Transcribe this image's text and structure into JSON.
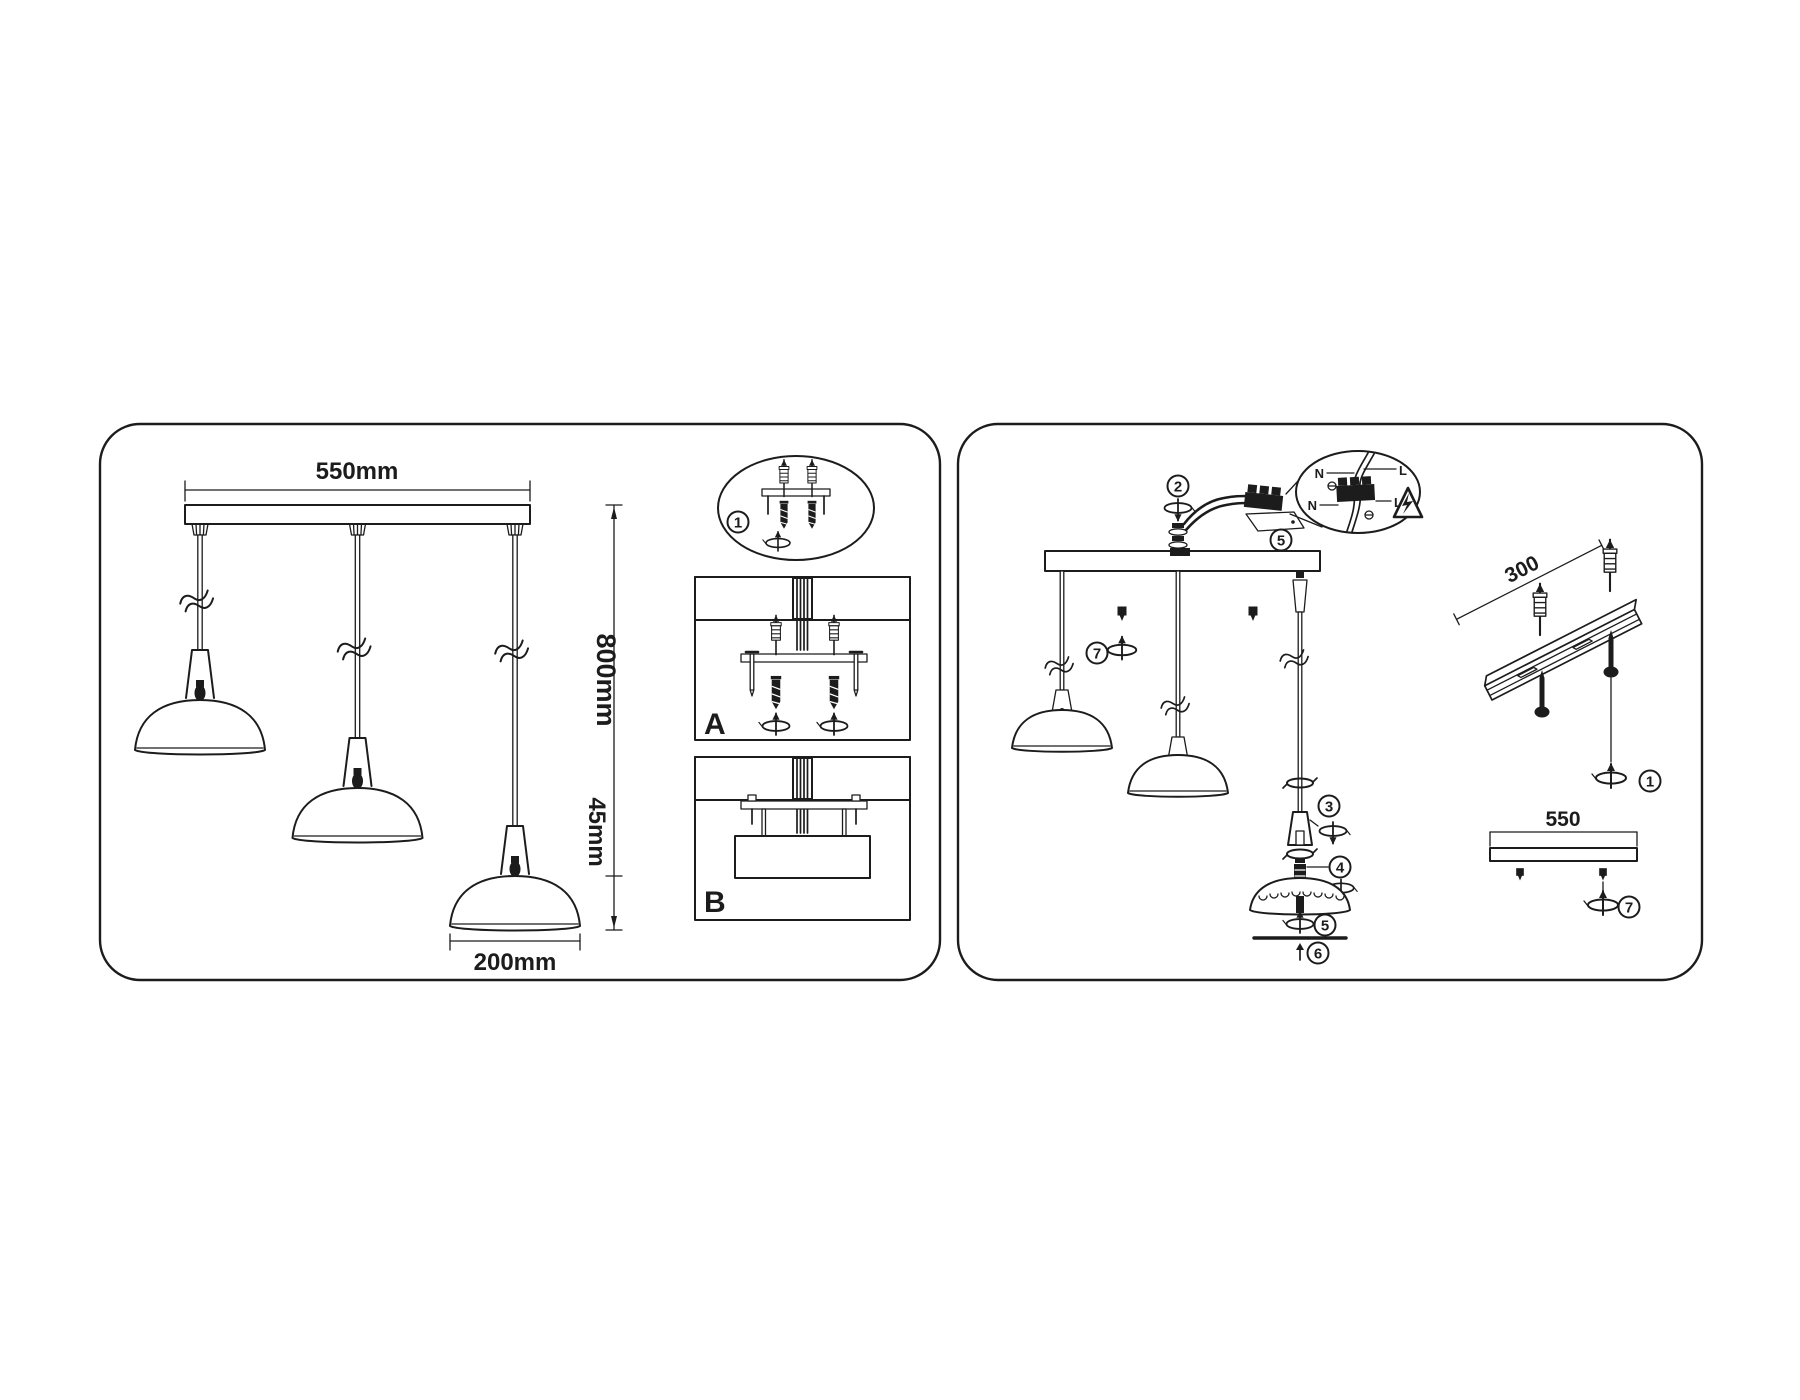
{
  "document_type": "pendant-lamp-installation-diagram",
  "colors": {
    "ink": "#1c1c1c",
    "paper": "#ffffff"
  },
  "icons": {
    "rotation_arrow": "screw-rotation-symbol",
    "warning_electric": "electric-shock-warning-triangle",
    "cable_break": "cable-break-squiggle"
  },
  "left": {
    "dim_width": "550mm",
    "dim_height": "800mm",
    "dim_shade_height": "45mm",
    "dim_shade_width": "200mm",
    "badge_detail": "1",
    "section_a": "A",
    "section_b": "B"
  },
  "right": {
    "b2": "2",
    "b5a": "5",
    "b7a": "7",
    "b3": "3",
    "b4": "4",
    "b5b": "5",
    "b6": "6",
    "b1": "1",
    "b7b": "7",
    "dim_rail": "300",
    "dim_bar": "550",
    "wiring": {
      "n_upper": "N",
      "l_upper": "L",
      "n_lower": "N",
      "l_lower": "L"
    }
  }
}
